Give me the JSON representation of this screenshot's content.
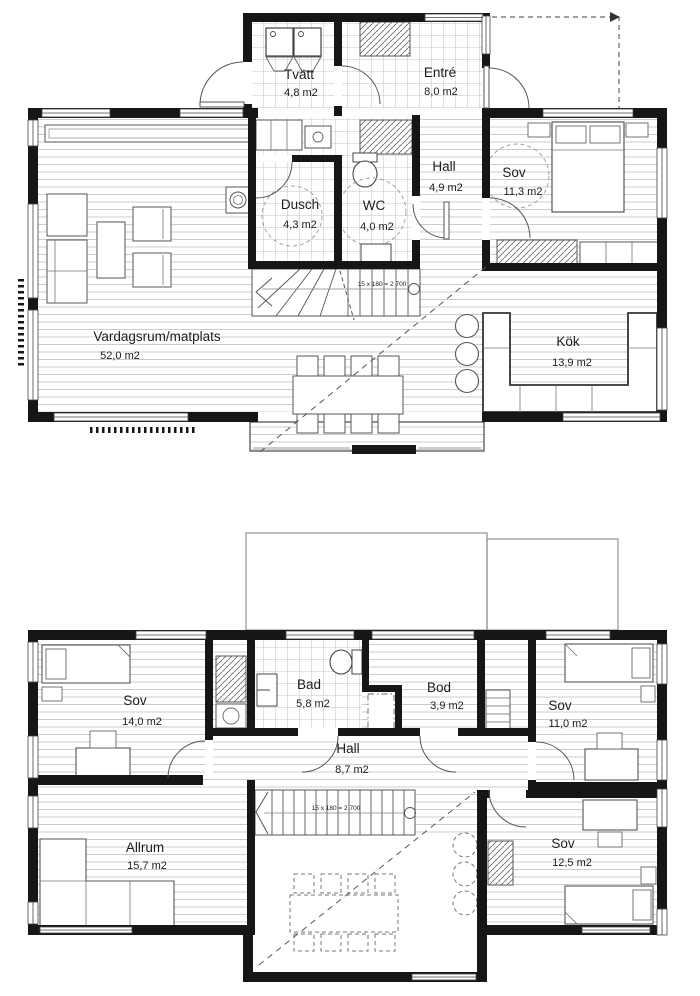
{
  "drawing": {
    "type": "floor-plan",
    "floors": {
      "f1": {
        "stair_note": "15 x 180 = 2 700",
        "rooms": {
          "tvatt": {
            "name": "Tvätt",
            "area": "4,8 m2"
          },
          "entre": {
            "name": "Entré",
            "area": "8,0 m2"
          },
          "dusch": {
            "name": "Dusch",
            "area": "4,3 m2"
          },
          "wc": {
            "name": "WC",
            "area": "4,0 m2"
          },
          "hall": {
            "name": "Hall",
            "area": "4,9 m2"
          },
          "sov": {
            "name": "Sov",
            "area": "11,3 m2"
          },
          "vardagsrum": {
            "name": "Vardagsrum/matplats",
            "area": "52,0 m2"
          },
          "kok": {
            "name": "Kök",
            "area": "13,9 m2"
          }
        }
      },
      "f2": {
        "stair_note": "15 x 180 = 2 700",
        "rooms": {
          "sov1": {
            "name": "Sov",
            "area": "14,0 m2"
          },
          "bad": {
            "name": "Bad",
            "area": "5,8 m2"
          },
          "bod": {
            "name": "Bod",
            "area": "3,9 m2"
          },
          "sov2": {
            "name": "Sov",
            "area": "11,0 m2"
          },
          "hall": {
            "name": "Hall",
            "area": "8,7 m2"
          },
          "allrum": {
            "name": "Allrum",
            "area": "15,7 m2"
          },
          "sov3": {
            "name": "Sov",
            "area": "12,5 m2"
          }
        }
      }
    },
    "colors": {
      "wall": "#161616",
      "line": "#444444",
      "dash": "#555555"
    }
  }
}
